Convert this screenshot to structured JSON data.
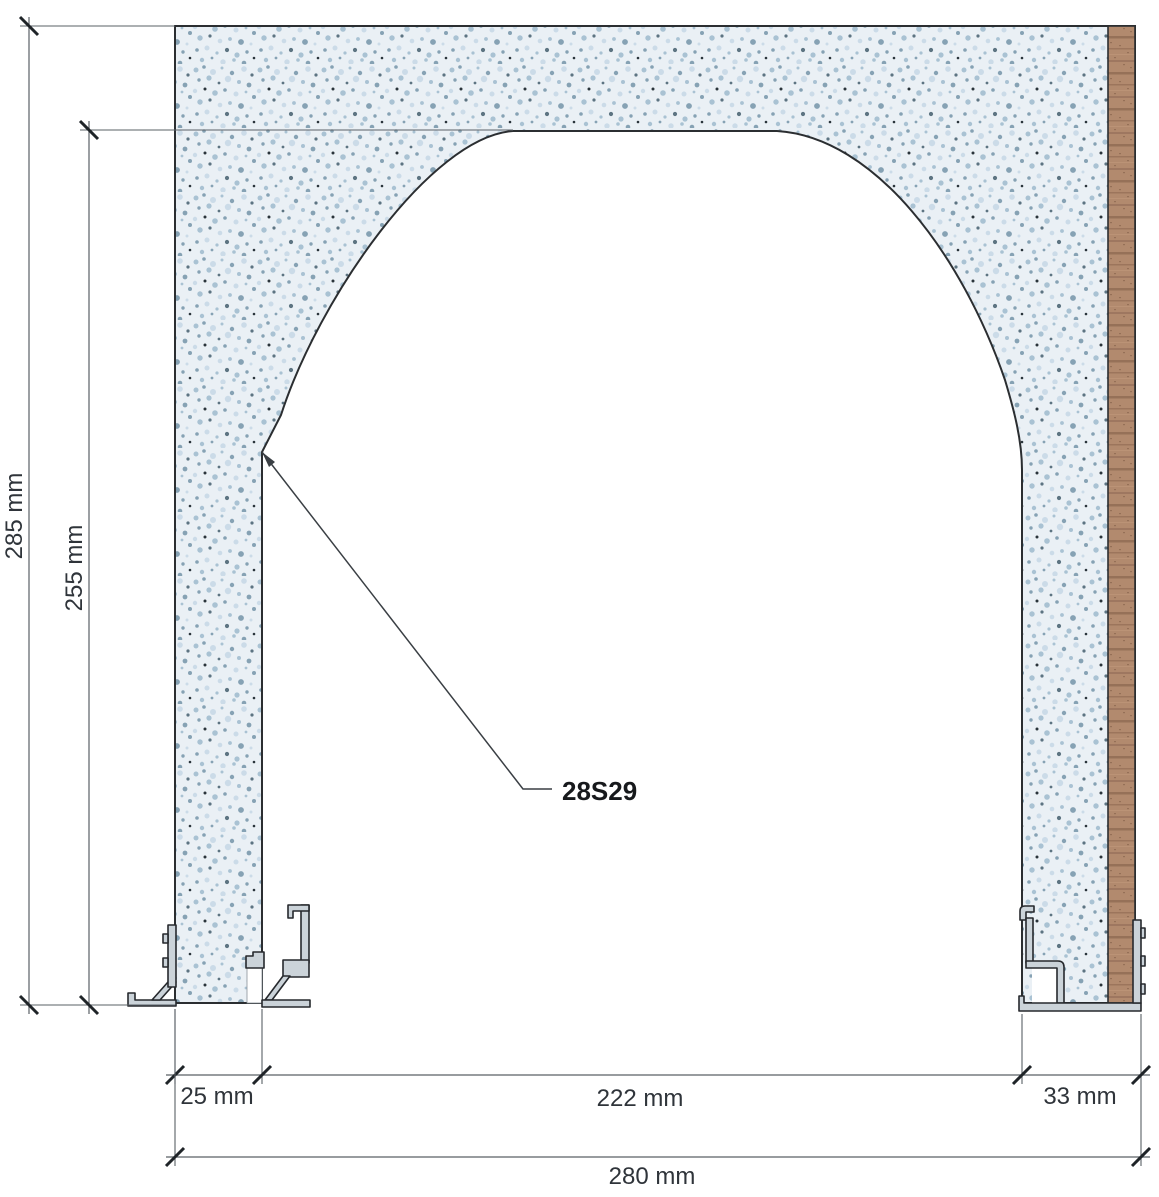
{
  "drawing": {
    "title": "arched wall opening cross-section",
    "part_label": "28S29",
    "dimensions": {
      "total_height": "285 mm",
      "opening_height": "255 mm",
      "left_jamb_width": "25 mm",
      "opening_width": "222 mm",
      "right_jamb_width": "33 mm",
      "total_width": "280 mm"
    },
    "materials": {
      "wall": "speckled stone / plaster",
      "right_face": "wood veneer strip",
      "bottom": "aluminium sill and track profiles"
    },
    "colors": {
      "stone_base": "#eaf0f5",
      "stone_speckle": "#a9c2d3",
      "wood": "#b28a6e",
      "profile_fill": "#cbd3d9",
      "outline": "#2b2e31",
      "dimension_line": "#5a6066",
      "text": "#2f343a"
    }
  }
}
